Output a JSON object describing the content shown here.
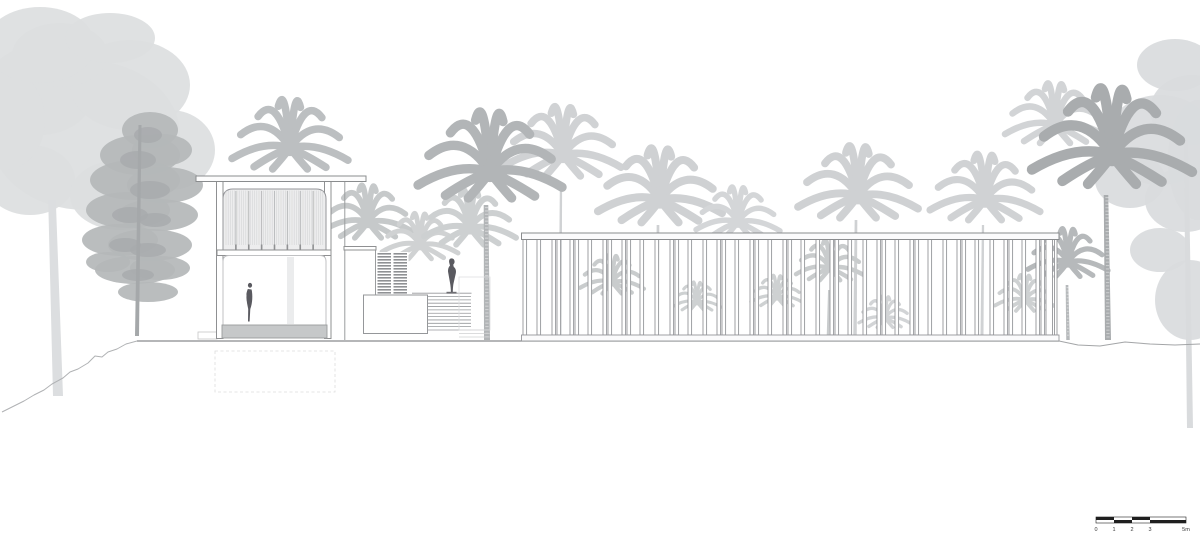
{
  "scale_bar": {
    "labels": [
      "0",
      "1",
      "2",
      "3",
      "5m"
    ],
    "x": 1096,
    "y": 517,
    "segment_px": [
      18,
      18,
      18,
      36
    ],
    "bar_color": "#1f1f1f",
    "label_color": "#3a3a3a"
  },
  "palette": {
    "line": "#8f9092",
    "line_soft": "#b0b2b4",
    "ground_main": "#898b8d",
    "ground_right": "#a3a5a7",
    "figure_dark": "#5a5a60",
    "plinth": "#c6c8c9",
    "white": "#ffffff"
  },
  "drawing": {
    "ground": {
      "main": [
        [
          137,
          341
        ],
        [
          1059,
          341
        ]
      ],
      "right": [
        [
          1059,
          341
        ],
        [
          1078,
          345
        ],
        [
          1100,
          346
        ],
        [
          1125,
          342
        ],
        [
          1150,
          344
        ],
        [
          1175,
          345
        ],
        [
          1200,
          344
        ]
      ],
      "slope_left": [
        [
          137,
          341
        ],
        [
          126,
          344
        ],
        [
          117,
          349
        ],
        [
          108,
          352
        ],
        [
          102,
          357
        ],
        [
          95,
          356
        ],
        [
          88,
          363
        ],
        [
          78,
          369
        ],
        [
          70,
          372
        ],
        [
          63,
          378
        ],
        [
          52,
          384
        ],
        [
          44,
          390
        ],
        [
          34,
          395
        ],
        [
          24,
          401
        ],
        [
          14,
          406
        ],
        [
          2,
          412
        ]
      ]
    },
    "trees": [
      {
        "name": "left-broadleaf-tree",
        "color": "#dcdee0",
        "blobs": [
          [
            85,
            135,
            95,
            75
          ],
          [
            40,
            90,
            55,
            45
          ],
          [
            130,
            85,
            60,
            45
          ],
          [
            170,
            150,
            45,
            40
          ],
          [
            30,
            180,
            45,
            35
          ],
          [
            120,
            195,
            50,
            35
          ],
          [
            60,
            55,
            48,
            32
          ],
          [
            5,
            120,
            40,
            50
          ],
          [
            40,
            45,
            55,
            38
          ],
          [
            110,
            38,
            45,
            25
          ]
        ],
        "trunk": [
          52,
          200,
          58,
          396,
          10
        ]
      },
      {
        "name": "right-broadleaf-tree",
        "color": "#d9dbdd",
        "blobs": [
          [
            1160,
            140,
            55,
            45
          ],
          [
            1192,
            110,
            42,
            35
          ],
          [
            1130,
            180,
            35,
            28
          ],
          [
            1185,
            200,
            40,
            32
          ],
          [
            1160,
            250,
            30,
            22
          ],
          [
            1190,
            300,
            35,
            40
          ],
          [
            1175,
            65,
            38,
            26
          ],
          [
            1198,
            160,
            30,
            60
          ]
        ],
        "trunk": [
          1186,
          140,
          1190,
          428,
          6
        ]
      },
      {
        "name": "pine-tree",
        "color": "#b4b7b9",
        "blobs": [
          [
            150,
            130,
            28,
            18
          ],
          [
            140,
            155,
            40,
            20
          ],
          [
            162,
            150,
            30,
            16
          ],
          [
            135,
            180,
            45,
            20
          ],
          [
            165,
            185,
            38,
            18
          ],
          [
            128,
            210,
            42,
            18
          ],
          [
            158,
            215,
            40,
            16
          ],
          [
            120,
            240,
            38,
            16
          ],
          [
            150,
            245,
            42,
            16
          ],
          [
            135,
            270,
            40,
            14
          ],
          [
            160,
            268,
            30,
            12
          ],
          [
            148,
            292,
            30,
            10
          ],
          [
            108,
            262,
            22,
            10
          ]
        ],
        "accent_color": "#a7aaac",
        "accents": [
          [
            148,
            135,
            14,
            8
          ],
          [
            138,
            160,
            18,
            9
          ],
          [
            150,
            190,
            20,
            9
          ],
          [
            130,
            215,
            18,
            8
          ],
          [
            155,
            220,
            16,
            7
          ],
          [
            125,
            245,
            16,
            7
          ],
          [
            148,
            250,
            18,
            7
          ],
          [
            138,
            275,
            16,
            6
          ]
        ],
        "trunk": [
          140,
          125,
          137,
          336,
          4
        ]
      }
    ],
    "palms": [
      {
        "x": 563,
        "y": 155,
        "r": 58,
        "color": "#d0d2d4",
        "trunk": [
          561,
          185,
          560,
          335,
          3
        ]
      },
      {
        "x": 660,
        "y": 200,
        "r": 62,
        "color": "#cfd1d3",
        "trunk": [
          658,
          225,
          657,
          335,
          3.5
        ]
      },
      {
        "x": 738,
        "y": 222,
        "r": 42,
        "color": "#d4d6d8",
        "trunk": null
      },
      {
        "x": 858,
        "y": 196,
        "r": 60,
        "color": "#cfd1d3",
        "trunk": [
          856,
          220,
          855,
          335,
          3.5
        ]
      },
      {
        "x": 985,
        "y": 200,
        "r": 55,
        "color": "#d0d2d4",
        "trunk": [
          983,
          225,
          982,
          335,
          3
        ]
      },
      {
        "x": 612,
        "y": 282,
        "r": 32,
        "color": "#c9cccd",
        "trunk": [
          611,
          300,
          610,
          335,
          2.5
        ]
      },
      {
        "x": 697,
        "y": 302,
        "r": 24,
        "color": "#ced1d2",
        "trunk": null
      },
      {
        "x": 777,
        "y": 297,
        "r": 26,
        "color": "#ced1d2",
        "trunk": null
      },
      {
        "x": 830,
        "y": 268,
        "r": 34,
        "color": "#c9cccd",
        "trunk": [
          829,
          290,
          828,
          335,
          2.5
        ]
      },
      {
        "x": 885,
        "y": 318,
        "r": 26,
        "color": "#d2d4d6",
        "trunk": null
      },
      {
        "x": 1025,
        "y": 300,
        "r": 30,
        "color": "#ced1d2",
        "trunk": null
      },
      {
        "x": 290,
        "y": 148,
        "r": 58,
        "color": "#bcbfc1",
        "trunk": null
      },
      {
        "x": 368,
        "y": 222,
        "r": 44,
        "color": "#c6c9ca",
        "trunk": null
      },
      {
        "x": 420,
        "y": 245,
        "r": 38,
        "color": "#d0d2d3",
        "trunk": null
      },
      {
        "x": 470,
        "y": 228,
        "r": 46,
        "color": "#cdd0d1",
        "trunk": null
      },
      {
        "x": 490,
        "y": 172,
        "r": 72,
        "color": "#b2b5b7",
        "trunk": [
          486,
          205,
          487,
          340,
          6
        ],
        "textured": true
      },
      {
        "x": 1055,
        "y": 125,
        "r": 50,
        "color": "#d2d4d6",
        "trunk": null
      },
      {
        "x": 1068,
        "y": 262,
        "r": 40,
        "color": "#b6b9bb",
        "trunk": [
          1067,
          285,
          1068,
          340,
          3.5
        ],
        "textured": true
      },
      {
        "x": 1112,
        "y": 155,
        "r": 80,
        "color": "#a9acae",
        "trunk": [
          1106,
          195,
          1108,
          340,
          6
        ],
        "textured": true
      }
    ],
    "pavilion": {
      "roof": [
        196,
        176,
        170,
        5.5
      ],
      "columns": [
        [
          216.5,
          181.5,
          6.5,
          157
        ],
        [
          324.5,
          181.5,
          6.5,
          157
        ]
      ],
      "screen": {
        "x": 223,
        "y": 189,
        "w": 103,
        "h": 61,
        "rx": 10,
        "fill": "#ededee",
        "bays": 8
      },
      "rail": [
        217,
        250,
        114,
        5.5
      ],
      "opening": {
        "x": 223,
        "y": 255.5,
        "w": 103,
        "h": 70,
        "rx": 6
      },
      "inner_trunk": [
        287,
        257,
        7,
        67
      ],
      "plinth": [
        222,
        325,
        105,
        13
      ],
      "dashed_pit": [
        215,
        351,
        120,
        41
      ],
      "side_step": [
        198,
        332,
        19,
        7
      ]
    },
    "mid_structure": {
      "roof": [
        344,
        246.5,
        32,
        3.5
      ],
      "wall_lines": [
        [
          344.8,
          182,
          344.8,
          340
        ],
        [
          375.5,
          250,
          375.5,
          295
        ]
      ],
      "louver_backing": [
        376.5,
        252,
        32,
        44
      ],
      "louver_stacks": [
        {
          "x": 377.5,
          "y": 253,
          "w": 13.5,
          "count": 14,
          "step": 3,
          "bar_h": 1.6
        },
        {
          "x": 393.5,
          "y": 253,
          "w": 13.5,
          "count": 14,
          "step": 3,
          "bar_h": 1.6
        }
      ],
      "wall": [
        363.5,
        295,
        64,
        38.5
      ],
      "steps": {
        "x": 427.5,
        "y": 296.5,
        "w": 43.5,
        "count": 11,
        "step": 3.35
      },
      "pedestal_line": [
        412,
        293.2,
        471.5,
        293.2
      ],
      "distant": {
        "rect": [
          459,
          277,
          31,
          53
        ],
        "base_lines": [
          [
            459,
            330,
            490,
            330
          ],
          [
            459,
            333.5,
            490,
            333.5
          ],
          [
            459,
            337,
            490,
            337
          ]
        ]
      }
    },
    "colonnade": {
      "beam": [
        521.5,
        233,
        537.5,
        6.5
      ],
      "rail": [
        521.5,
        335,
        537.5,
        6
      ],
      "post_top": 239.5,
      "post_h": 95.5,
      "post_w": 3.6,
      "posts": [
        523,
        537,
        552,
        557,
        570,
        575,
        588,
        603,
        608,
        622,
        627,
        640,
        655,
        670,
        675,
        688,
        703,
        717,
        722,
        735,
        750,
        755,
        768,
        783,
        788,
        801,
        816,
        830,
        835,
        848,
        863,
        877,
        882,
        895,
        910,
        915,
        928,
        943,
        957,
        962,
        975,
        990,
        1004,
        1009,
        1022,
        1036,
        1041
      ],
      "wide_post": {
        "x": 1046,
        "w": 6.5
      },
      "end_post": 1054.5
    },
    "figures": {
      "person": {
        "head": [
          250,
          285.3,
          2.1,
          2.4
        ],
        "body": "M247.8,289 C246.2,293 245.6,297 246.6,301 L248.2,309 L248,321.5 L249.6,321.5 L250.3,309 C252.6,303 252.8,295 251.6,289.5 Z",
        "notch": "M246.6,293.5 L244.6,299.5 L246.9,304 L246.4,297.5 Z"
      },
      "statue": {
        "path": "M449.8,259 C451.5,257.8 453.6,258.4 454.3,260.2 C455,262 454.4,263.6 453.2,264.6 L453.8,267 C455.6,268.2 456.4,270.6 455.8,273.4 L453.4,284 C453,286.6 452.8,289.4 452.8,292.6 L450.9,292.6 C450.9,289.2 450.6,286 450,282.8 L448.2,272.6 C447.7,269.8 448.4,267.2 450,265.6 L449.2,262.6 C448.9,261.2 449.1,260 449.8,259 Z",
        "base": [
          446.5,
          291.8,
          10,
          1.8
        ]
      }
    }
  }
}
